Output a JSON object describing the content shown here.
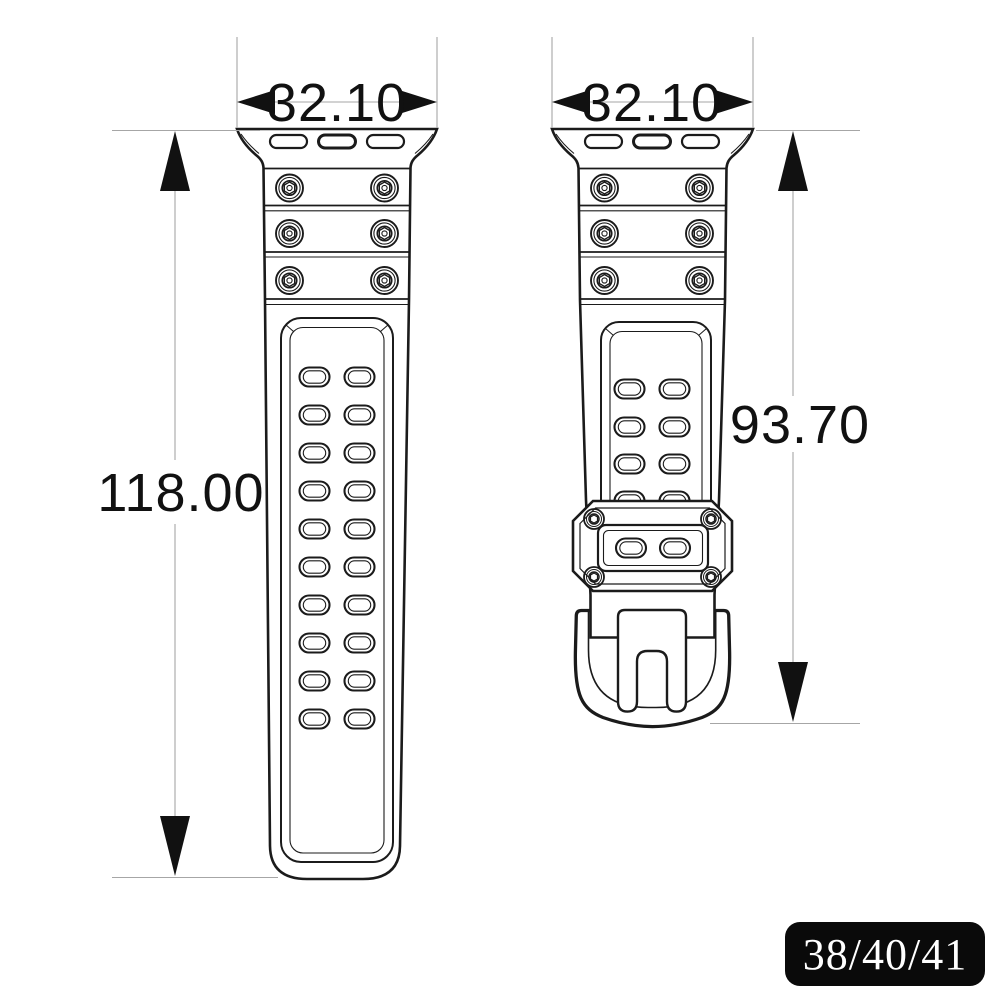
{
  "drawing": {
    "left_view": {
      "name": "long-strap-view",
      "width_label": "32.10",
      "length_label": "118.00"
    },
    "right_view": {
      "name": "buckle-strap-view",
      "width_label": "32.10",
      "length_label": "93.70"
    }
  },
  "badge": {
    "label": "38/40/41"
  },
  "colors": {
    "line": "#1b1b1b",
    "dimension_line": "#a6a6a6",
    "arrow_and_text": "#111111",
    "badge_bg": "#0a0a0a",
    "badge_text": "#ffffff",
    "background": "#ffffff"
  }
}
